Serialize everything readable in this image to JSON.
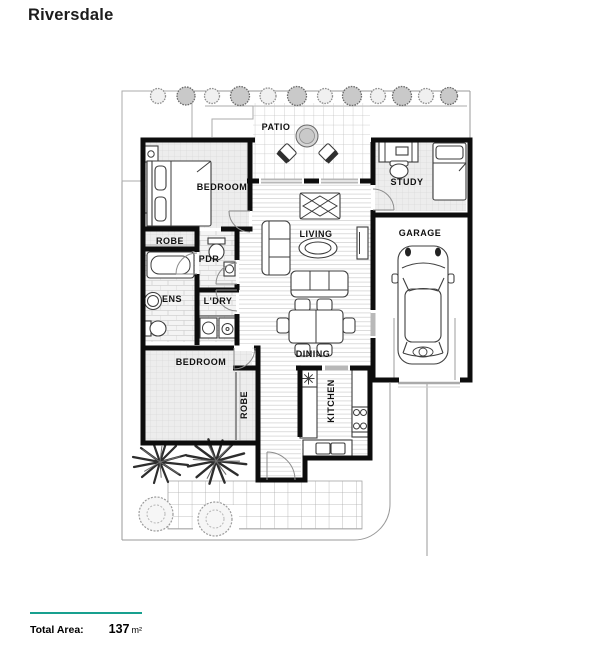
{
  "title": "Riversdale",
  "rooms": [
    {
      "id": "patio",
      "label": "PATIO"
    },
    {
      "id": "bedroom-1",
      "label": "BEDROOM"
    },
    {
      "id": "study",
      "label": "STUDY"
    },
    {
      "id": "living",
      "label": "LIVING"
    },
    {
      "id": "garage",
      "label": "GARAGE"
    },
    {
      "id": "robe-1",
      "label": "ROBE"
    },
    {
      "id": "pdr",
      "label": "PDR"
    },
    {
      "id": "ens",
      "label": "ENS"
    },
    {
      "id": "ldry",
      "label": "L'DRY"
    },
    {
      "id": "dining",
      "label": "DINING"
    },
    {
      "id": "bedroom-2",
      "label": "BEDROOM"
    },
    {
      "id": "robe-2",
      "label": "ROBE"
    },
    {
      "id": "kitchen",
      "label": "KITCHEN"
    }
  ],
  "footer": {
    "label": "Total Area:",
    "value": "137",
    "unit": "m²"
  },
  "colors": {
    "accent_teal": "#18a08f",
    "wall": "#0d0d0d",
    "label_text": "#111111"
  }
}
